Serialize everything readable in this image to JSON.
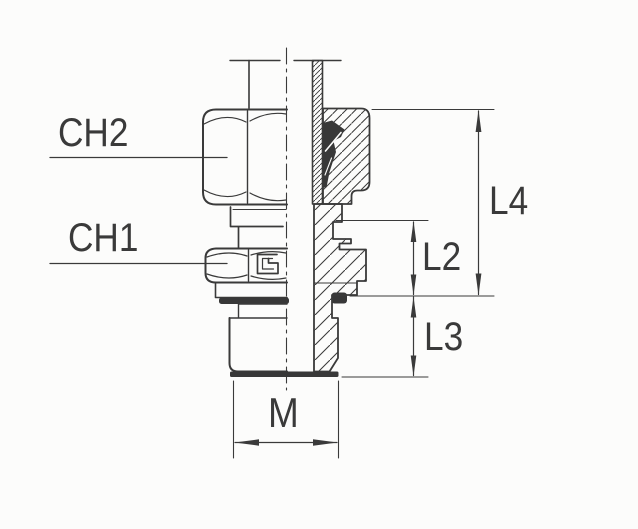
{
  "figure": {
    "colors": {
      "background": "#fcfcfb",
      "line": "#3a3a3a",
      "solid_fill": "#383838"
    },
    "callouts": {
      "ch2": "CH2",
      "ch1": "CH1"
    },
    "dimensions": {
      "l4": "L4",
      "l2": "L2",
      "l3": "L3",
      "m": "M"
    }
  }
}
